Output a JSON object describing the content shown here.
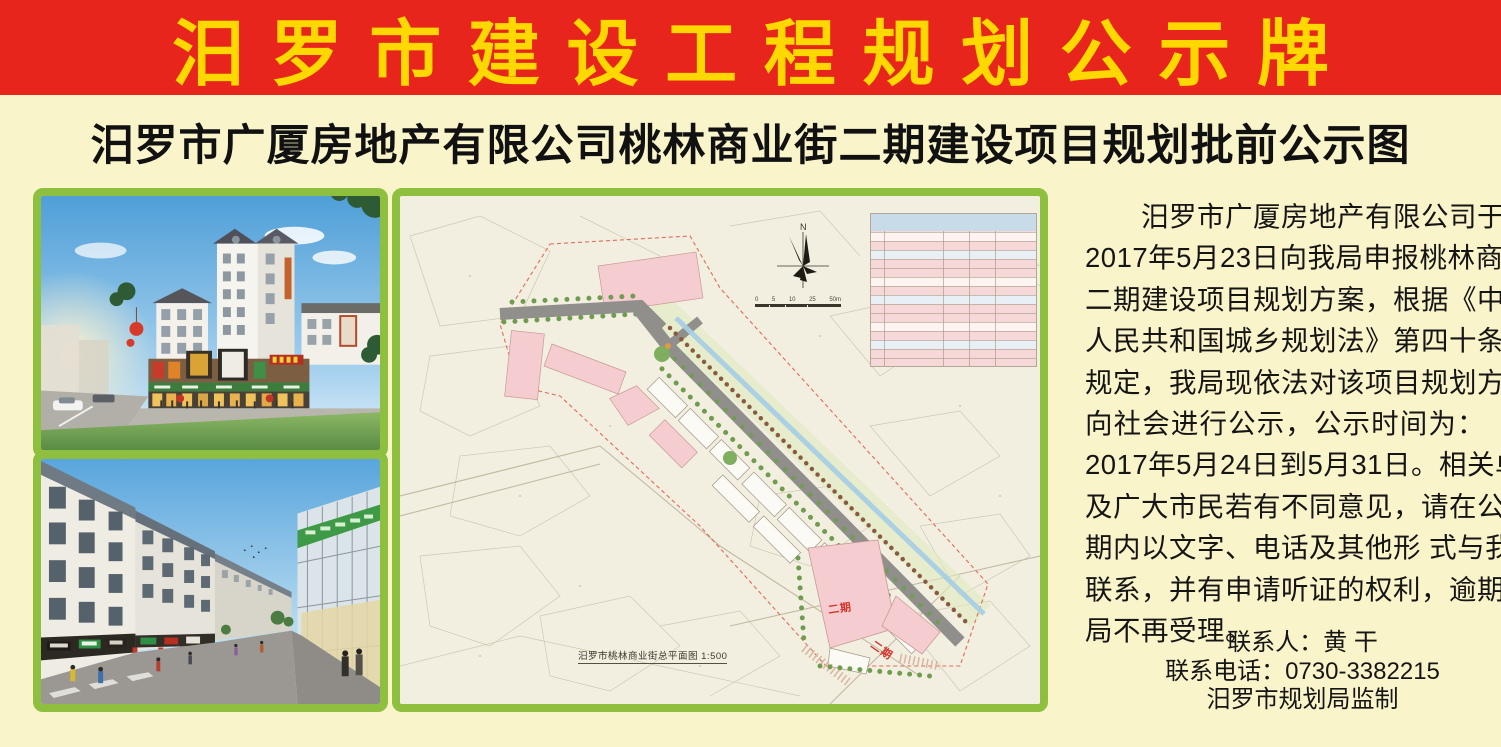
{
  "banner": {
    "title": "汨罗市建设工程规划公示牌"
  },
  "subtitle": {
    "text": "汨罗市广厦房地产有限公司桃林商业街二期建设项目规划批前公示图"
  },
  "notice": {
    "lines": [
      "　　汨罗市广厦房地产有限公司于",
      "2017年5月23日向我局申报桃林商业街",
      "二期建设项目规划方案，根据《中华",
      "人民共和国城乡规划法》第四十条之",
      "规定，我局现依法对该项目规划方案",
      "向社会进行公示，公示时间为：",
      "2017年5月24日到5月31日。相关单位",
      "及广大市民若有不同意见，请在公示",
      "期内以文字、电话及其他形 式与我局",
      "联系，并有申请听证的权利，逾期我",
      "局不再受理。"
    ],
    "contact_person": "联系人：黄 干",
    "contact_phone": "联系电话：0730-3382215",
    "issuer": "汨罗市规划局监制"
  },
  "plan": {
    "north_label": "N",
    "caption": "汨罗市桃林商业街总平面图 1:500",
    "phase_labels": [
      "二期",
      "二期"
    ],
    "scale_ticks": [
      "0",
      "5",
      "10",
      "25",
      "50m"
    ]
  },
  "colors": {
    "banner_red": "#e8251c",
    "banner_yellow": "#ffd800",
    "board_cream": "#faf4ca",
    "frame_green": "#8fbf3e",
    "plan_paper": "#f2efe1",
    "building_pink": "#f5cdd1",
    "phase_red": "#d8322a"
  }
}
